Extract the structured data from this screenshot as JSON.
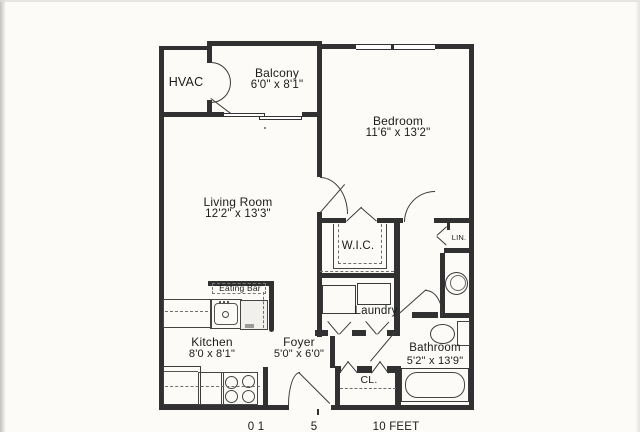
{
  "rooms": {
    "hvac": {
      "label": "HVAC"
    },
    "balcony": {
      "label": "Balcony",
      "dims": "6'0\" x 8'1\""
    },
    "bedroom": {
      "label": "Bedroom",
      "dims": "11'6\" x 13'2\""
    },
    "living_room": {
      "label": "Living Room",
      "dims": "12'2\" x 13'3\""
    },
    "wic": {
      "label": "W.I.C."
    },
    "linen": {
      "label": "LIN."
    },
    "laundry": {
      "label": "Laundry"
    },
    "eating_bar": {
      "label": "Eating Bar"
    },
    "kitchen": {
      "label": "Kitchen",
      "dims": "8'0 x 8'1\""
    },
    "foyer": {
      "label": "Foyer",
      "dims": "5'0\" x 6'0\""
    },
    "closet": {
      "label": "CL."
    },
    "bathroom": {
      "label": "Bathroom",
      "dims": "5'2\" x 13'9\""
    }
  },
  "scale_bar": {
    "mark_0_1": "0 1",
    "mark_5": "5",
    "mark_10_feet": "10 FEET"
  },
  "colors": {
    "wall": "#313131",
    "fixture_line": "#454545",
    "paper": "#fcfbf8"
  }
}
